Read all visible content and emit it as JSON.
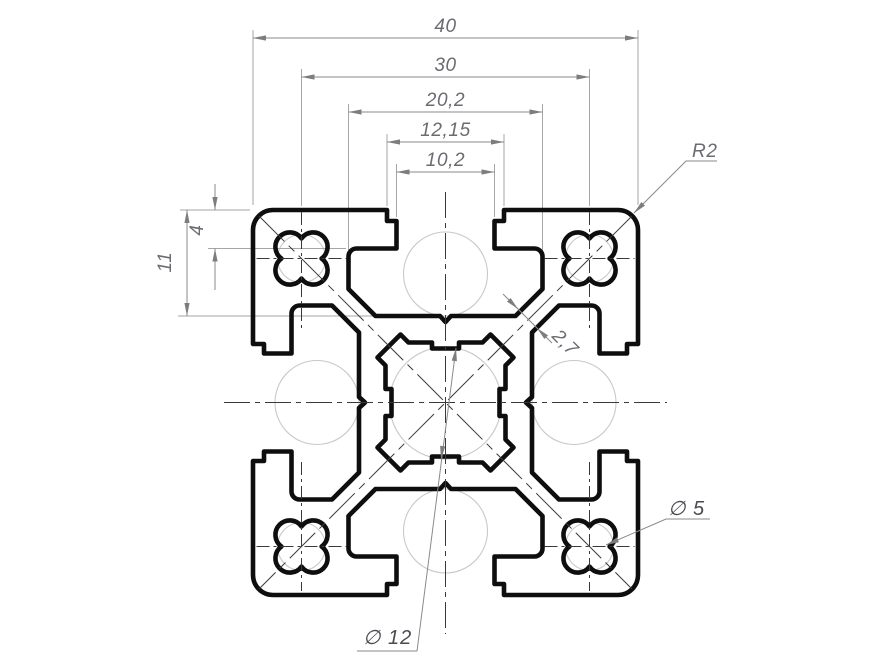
{
  "drawing": {
    "type": "technical-drawing",
    "subject": "aluminium-t-slot-extrusion-profile-cross-section",
    "dimensions": {
      "overall_width": "40",
      "hole_spacing": "30",
      "cavity_width": "20,2",
      "outer_opening": "12,15",
      "slot_opening": "10,2",
      "lip_depth": "4",
      "slot_depth": "11",
      "corner_radius": "R2",
      "wall_thickness": "2,7",
      "corner_hole_diameter": "∅ 5",
      "center_bore_diameter": "∅ 12"
    },
    "colors": {
      "background": "#ffffff",
      "profile_outline": "#0e0e0e",
      "dimension_lines": "#8a8a8a",
      "extension_lines": "#a6a6a6",
      "dimension_text": "#6b6b72",
      "leader_text": "#4a4a52",
      "centerlines": "#3a3a3a",
      "reference_circles": "#c9c9c9"
    }
  }
}
